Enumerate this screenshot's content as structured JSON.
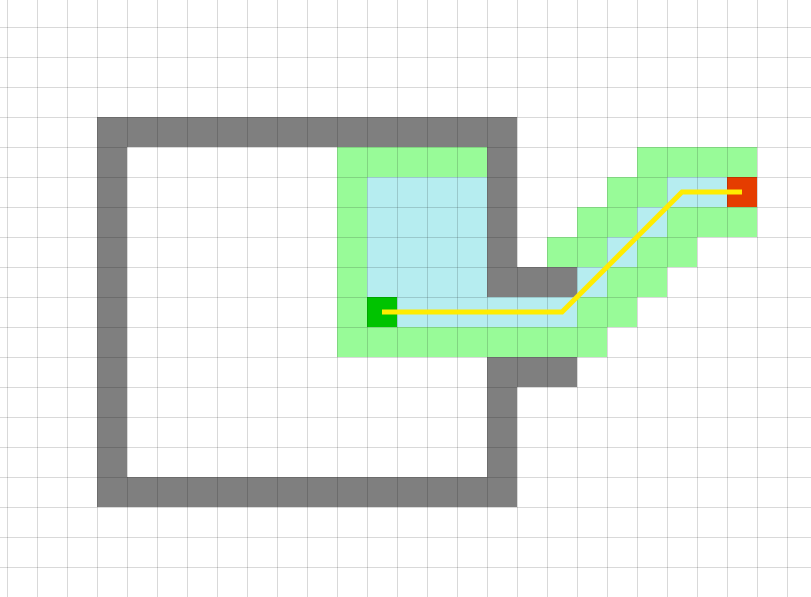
{
  "canvas": {
    "width": 811,
    "height": 597,
    "background": "#ffffff"
  },
  "grid": {
    "offset_x": 7,
    "offset_y": 27,
    "cell_w": 30,
    "cell_h": 30,
    "v_line_count": 27,
    "h_line_count": 20,
    "line_color": "rgba(0,0,0,0.15)",
    "line_width": 1
  },
  "colors": {
    "wall": "#7f7f7f",
    "explored_green": "#98fb98",
    "visited_cyan": "#b6edf0",
    "start": "#00c300",
    "goal": "#e53d00",
    "path": "#ffec00"
  },
  "cells": {
    "wall_rects": [
      [
        3,
        3,
        16,
        3
      ],
      [
        3,
        4,
        3,
        14
      ],
      [
        3,
        15,
        16,
        15
      ],
      [
        16,
        4,
        16,
        8
      ],
      [
        16,
        11,
        16,
        14
      ],
      [
        17,
        8,
        18,
        8
      ],
      [
        17,
        11,
        18,
        11
      ]
    ],
    "explored_green_rects": [
      [
        11,
        4,
        15,
        4
      ],
      [
        11,
        5,
        11,
        9
      ],
      [
        11,
        10,
        19,
        10
      ],
      [
        19,
        9,
        20,
        9
      ],
      [
        20,
        8,
        21,
        8
      ],
      [
        18,
        7,
        19,
        7
      ],
      [
        21,
        7,
        22,
        7
      ],
      [
        19,
        6,
        20,
        6
      ],
      [
        22,
        6,
        24,
        6
      ],
      [
        20,
        5,
        21,
        5
      ],
      [
        21,
        4,
        24,
        4
      ]
    ],
    "visited_cyan_rects": [
      [
        12,
        5,
        15,
        8
      ],
      [
        13,
        9,
        18,
        9
      ],
      [
        19,
        8,
        19,
        8
      ],
      [
        20,
        7,
        20,
        7
      ],
      [
        21,
        6,
        21,
        6
      ],
      [
        22,
        5,
        23,
        5
      ]
    ]
  },
  "start_cell": {
    "col": 12,
    "row": 9
  },
  "goal_cell": {
    "col": 24,
    "row": 5
  },
  "path_cells": [
    [
      12,
      9
    ],
    [
      18,
      9
    ],
    [
      22,
      5
    ],
    [
      24,
      5
    ]
  ],
  "path_width": 5
}
